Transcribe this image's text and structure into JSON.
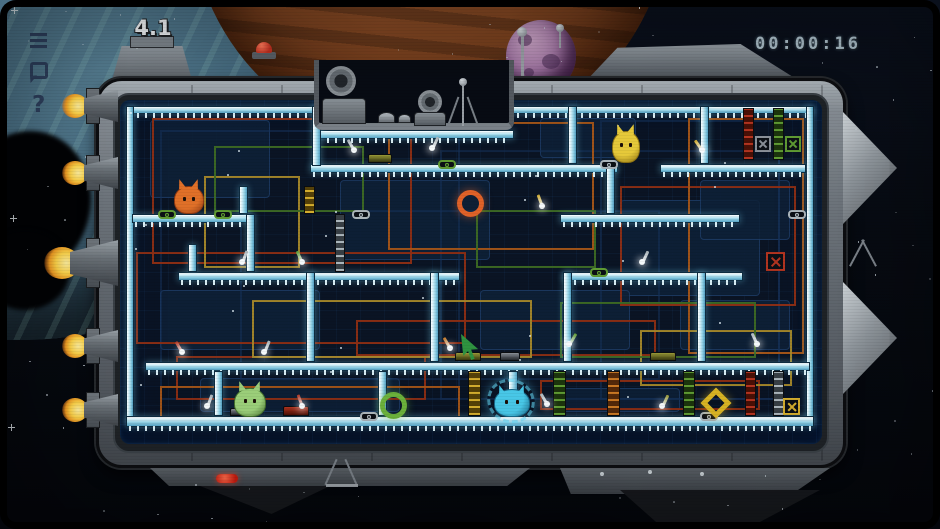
{
  "hud": {
    "level": "4.1",
    "timer": "00:00:16",
    "icons": [
      {
        "name": "menu-icon"
      },
      {
        "name": "restart-icon"
      },
      {
        "name": "help-icon",
        "glyph": "?"
      }
    ]
  },
  "colors": {
    "ice": "#8ecfe4",
    "hull": "#6d747b",
    "space": "#070b13",
    "timer_text": "#a9bcc6",
    "flame": "#f7b32a",
    "wire_red": "#8f2e14",
    "wire_orange": "#a85618",
    "wire_yellow": "#a8892a",
    "wire_green": "#3e6b24",
    "wire_blue": "#16325a",
    "wire_silver": "#8f9aa2"
  },
  "scene": {
    "creatures": [
      {
        "name": "orange-creature",
        "type": "blob",
        "x": 174,
        "y": 186,
        "w": 30,
        "h": 28,
        "c": "#e07028",
        "cd": "#8f3a12"
      },
      {
        "name": "yellow-creature",
        "type": "blob",
        "x": 612,
        "y": 131,
        "w": 28,
        "h": 32,
        "c": "#e6c93a",
        "cd": "#8f7312"
      },
      {
        "name": "green-creature",
        "type": "ghost",
        "x": 234,
        "y": 388,
        "w": 32,
        "h": 29,
        "c": "#9ccf7a",
        "cd": "#44702e"
      },
      {
        "name": "blue-creature",
        "type": "crab",
        "x": 494,
        "y": 389,
        "w": 36,
        "h": 28,
        "c": "#49c8e8",
        "cd": "#1a6a8a"
      }
    ],
    "portals": [
      {
        "name": "orange-ring",
        "shape": "ring",
        "x": 457,
        "y": 190,
        "s": 27,
        "c": "#e06228"
      },
      {
        "name": "green-ring",
        "shape": "ring",
        "x": 380,
        "y": 392,
        "s": 27,
        "c": "#6cb23c"
      },
      {
        "name": "yellow-diamond",
        "shape": "diamond",
        "x": 705,
        "y": 392,
        "s": 22,
        "c": "#d8b424"
      }
    ],
    "ice": [
      [
        126,
        106,
        198,
        8
      ],
      [
        506,
        106,
        308,
        8
      ],
      [
        316,
        130,
        198,
        9
      ],
      [
        126,
        106,
        8,
        318
      ],
      [
        806,
        106,
        8,
        318
      ],
      [
        126,
        416,
        688,
        11
      ],
      [
        310,
        164,
        308,
        9
      ],
      [
        660,
        164,
        146,
        9
      ],
      [
        132,
        214,
        120,
        9
      ],
      [
        560,
        214,
        180,
        9
      ],
      [
        178,
        272,
        282,
        9
      ],
      [
        563,
        272,
        180,
        9
      ],
      [
        145,
        362,
        665,
        9
      ],
      [
        312,
        106,
        9,
        60
      ],
      [
        568,
        106,
        9,
        58
      ],
      [
        700,
        106,
        9,
        58
      ],
      [
        606,
        164,
        9,
        50
      ],
      [
        239,
        186,
        9,
        28
      ],
      [
        188,
        244,
        9,
        28
      ],
      [
        246,
        214,
        9,
        58
      ],
      [
        430,
        272,
        9,
        90
      ],
      [
        306,
        272,
        9,
        90
      ],
      [
        563,
        272,
        9,
        90
      ],
      [
        697,
        272,
        9,
        90
      ],
      [
        214,
        371,
        9,
        45
      ],
      [
        378,
        371,
        9,
        45
      ],
      [
        508,
        371,
        10,
        45
      ]
    ],
    "columns": [
      [
        743,
        108,
        11,
        52,
        "red"
      ],
      [
        773,
        108,
        11,
        52,
        "green"
      ],
      [
        468,
        371,
        13,
        45,
        "yellow"
      ],
      [
        553,
        371,
        13,
        45,
        "green"
      ],
      [
        607,
        371,
        13,
        45,
        "orange"
      ],
      [
        683,
        371,
        12,
        45,
        "green"
      ],
      [
        745,
        371,
        11,
        45,
        "red"
      ],
      [
        773,
        371,
        11,
        45,
        "silver"
      ],
      [
        304,
        186,
        11,
        28,
        "yellow"
      ],
      [
        335,
        214,
        10,
        58,
        "silver"
      ]
    ],
    "xboxes": [
      [
        755,
        136,
        16,
        "dark"
      ],
      [
        785,
        136,
        16,
        "green"
      ],
      [
        766,
        252,
        19,
        "red"
      ],
      [
        783,
        398,
        17,
        "yellow"
      ]
    ],
    "wires": [
      [
        160,
        130,
        300,
        270,
        "blue"
      ],
      [
        440,
        150,
        340,
        250,
        "blue"
      ],
      [
        240,
        210,
        420,
        170,
        "blue"
      ],
      [
        600,
        120,
        180,
        280,
        "blue"
      ],
      [
        152,
        118,
        260,
        146,
        "red"
      ],
      [
        136,
        252,
        330,
        92,
        "red"
      ],
      [
        356,
        320,
        300,
        36,
        "red"
      ],
      [
        620,
        186,
        176,
        120,
        "red"
      ],
      [
        540,
        380,
        220,
        30,
        "red"
      ],
      [
        176,
        356,
        250,
        44,
        "red"
      ],
      [
        388,
        122,
        206,
        128,
        "orange"
      ],
      [
        688,
        118,
        116,
        236,
        "orange"
      ],
      [
        160,
        386,
        300,
        36,
        "orange"
      ],
      [
        204,
        176,
        96,
        92,
        "yellow"
      ],
      [
        252,
        300,
        280,
        58,
        "yellow"
      ],
      [
        640,
        330,
        152,
        56,
        "yellow"
      ],
      [
        214,
        146,
        150,
        66,
        "green"
      ],
      [
        560,
        302,
        196,
        56,
        "green"
      ],
      [
        476,
        210,
        120,
        58,
        "green"
      ]
    ],
    "levers": [
      [
        352,
        150,
        "silver",
        -30
      ],
      [
        430,
        148,
        "silver",
        25
      ],
      [
        540,
        206,
        "yellow",
        -20
      ],
      [
        700,
        150,
        "yellow",
        -35
      ],
      [
        240,
        262,
        "silver",
        20
      ],
      [
        300,
        262,
        "green",
        -25
      ],
      [
        640,
        262,
        "silver",
        25
      ],
      [
        180,
        352,
        "red",
        -30
      ],
      [
        262,
        352,
        "silver",
        22
      ],
      [
        448,
        348,
        "orange",
        -30
      ],
      [
        567,
        344,
        "green",
        30
      ],
      [
        755,
        344,
        "silver",
        -25
      ],
      [
        205,
        406,
        "silver",
        20
      ],
      [
        545,
        404,
        "silver",
        -30
      ],
      [
        660,
        406,
        "olive",
        25
      ],
      [
        300,
        406,
        "red",
        -20
      ]
    ],
    "connectors": [
      [
        158,
        210,
        "green"
      ],
      [
        214,
        210,
        "green"
      ],
      [
        352,
        210,
        "silver"
      ],
      [
        788,
        210,
        "silver"
      ],
      [
        438,
        160,
        "green"
      ],
      [
        600,
        160,
        "silver"
      ],
      [
        590,
        268,
        "green"
      ],
      [
        360,
        412,
        "silver"
      ],
      [
        700,
        412,
        "silver"
      ]
    ],
    "gadgets": [
      [
        283,
        406,
        26,
        10,
        "red"
      ],
      [
        455,
        352,
        26,
        9,
        "olive"
      ],
      [
        650,
        352,
        26,
        9,
        "olive"
      ],
      [
        368,
        154,
        24,
        9,
        "olive"
      ],
      [
        500,
        352,
        20,
        9,
        "dark"
      ],
      [
        230,
        408,
        18,
        8,
        "dark"
      ]
    ],
    "panels": [
      [
        150,
        120,
        120,
        78
      ],
      [
        340,
        180,
        150,
        80
      ],
      [
        540,
        118,
        96,
        40
      ],
      [
        620,
        200,
        140,
        96
      ],
      [
        160,
        290,
        160,
        60
      ],
      [
        480,
        290,
        150,
        60
      ],
      [
        680,
        300,
        110,
        50
      ],
      [
        200,
        378,
        200,
        34
      ],
      [
        560,
        388,
        120,
        24
      ],
      [
        700,
        180,
        90,
        60
      ]
    ],
    "thrusters": [
      {
        "y": 106,
        "big": false
      },
      {
        "y": 173,
        "big": false
      },
      {
        "y": 263,
        "big": true
      },
      {
        "y": 346,
        "big": false
      },
      {
        "y": 410,
        "big": false
      }
    ],
    "cursor": {
      "x": 461,
      "y": 334
    }
  }
}
